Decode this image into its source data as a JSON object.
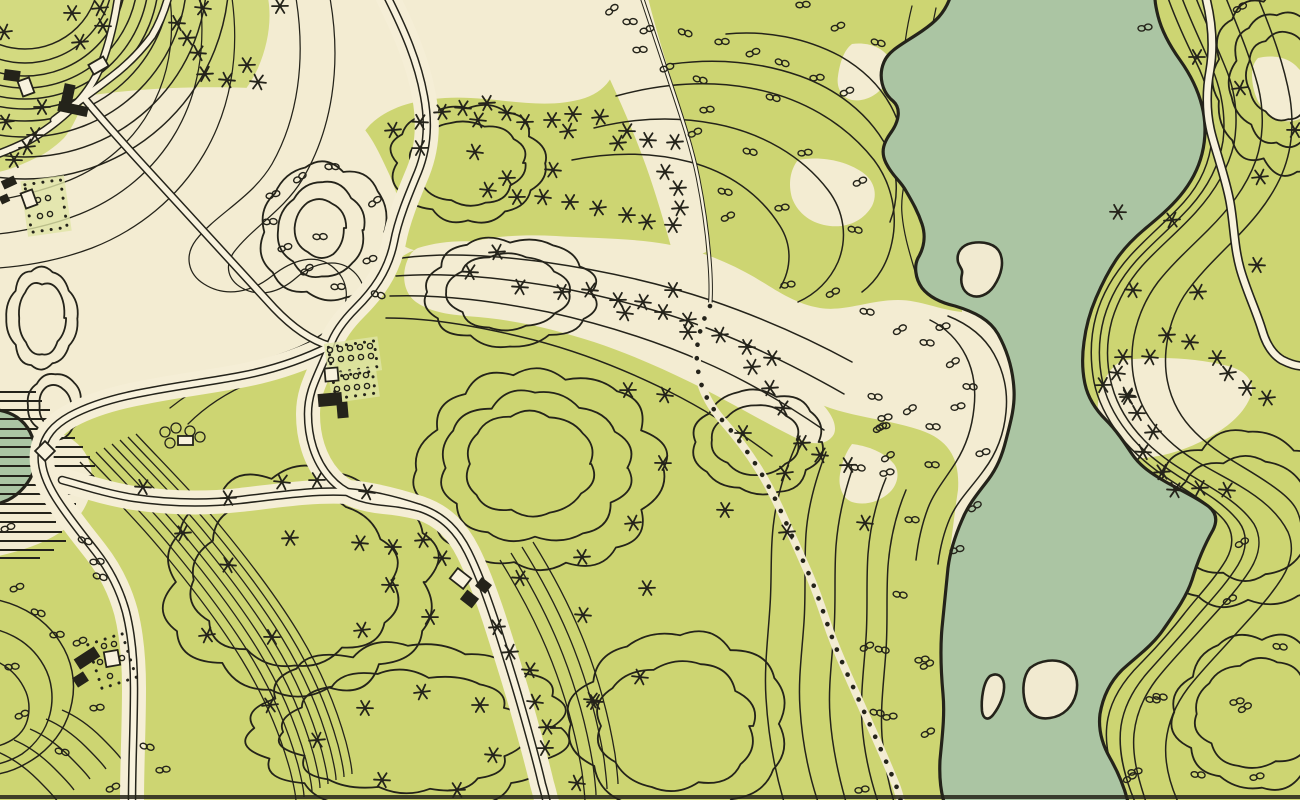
{
  "map": {
    "title": "Vintage hand-drawn topographic park survey map with lake channel, contour lines, wooded hills, winding roads, footpath and farmsteads",
    "style": "ink and watercolor plan, no text labels",
    "palette": {
      "paper": "#f3ecd2",
      "meadow": "#cdd572",
      "meadow_light": "#e0e5a6",
      "water": "#abc5a3",
      "ink": "#24231a",
      "road_fill": "#f8f2dd"
    },
    "legend": [
      {
        "symbol": "asterisk",
        "meaning": "coniferous tree"
      },
      {
        "symbol": "double-lobe",
        "meaning": "deciduous shrub / bush"
      },
      {
        "symbol": "solid-black-rectangle",
        "meaning": "building"
      },
      {
        "symbol": "open-rectangle",
        "meaning": "outbuilding / shed"
      },
      {
        "symbol": "dotted-square",
        "meaning": "garden plot / orchard"
      },
      {
        "symbol": "double-line",
        "meaning": "road"
      },
      {
        "symbol": "dotted-line",
        "meaning": "footpath"
      },
      {
        "symbol": "horizontal-hatching",
        "meaning": "marsh"
      },
      {
        "symbol": "thin-wavy-lines",
        "meaning": "elevation contours"
      },
      {
        "symbol": "scalloped-outline",
        "meaning": "wooded hilltop"
      }
    ],
    "features": {
      "water_bodies": 2,
      "islands": 3,
      "footpaths": 1,
      "road_junctions": 3,
      "building_clusters": 6
    }
  },
  "symbols": {
    "conifers": [
      [
        4,
        32
      ],
      [
        72,
        13
      ],
      [
        100,
        8
      ],
      [
        103,
        26
      ],
      [
        80,
        42
      ],
      [
        177,
        23
      ],
      [
        187,
        38
      ],
      [
        198,
        53
      ],
      [
        205,
        74
      ],
      [
        227,
        80
      ],
      [
        247,
        65
      ],
      [
        258,
        82
      ],
      [
        280,
        6
      ],
      [
        203,
        8
      ],
      [
        42,
        107
      ],
      [
        6,
        122
      ],
      [
        35,
        135
      ],
      [
        27,
        147
      ],
      [
        14,
        160
      ],
      [
        393,
        130
      ],
      [
        420,
        122
      ],
      [
        442,
        112
      ],
      [
        463,
        108
      ],
      [
        487,
        103
      ],
      [
        507,
        113
      ],
      [
        525,
        122
      ],
      [
        478,
        120
      ],
      [
        420,
        148
      ],
      [
        475,
        152
      ],
      [
        552,
        120
      ],
      [
        568,
        131
      ],
      [
        573,
        114
      ],
      [
        600,
        117
      ],
      [
        627,
        131
      ],
      [
        618,
        143
      ],
      [
        648,
        140
      ],
      [
        675,
        142
      ],
      [
        665,
        172
      ],
      [
        678,
        188
      ],
      [
        553,
        170
      ],
      [
        507,
        178
      ],
      [
        488,
        190
      ],
      [
        517,
        197
      ],
      [
        543,
        197
      ],
      [
        570,
        202
      ],
      [
        598,
        208
      ],
      [
        627,
        215
      ],
      [
        647,
        222
      ],
      [
        673,
        225
      ],
      [
        680,
        208
      ],
      [
        470,
        272
      ],
      [
        497,
        252
      ],
      [
        520,
        287
      ],
      [
        562,
        292
      ],
      [
        590,
        290
      ],
      [
        618,
        300
      ],
      [
        643,
        302
      ],
      [
        673,
        290
      ],
      [
        625,
        313
      ],
      [
        663,
        312
      ],
      [
        688,
        320
      ],
      [
        688,
        332
      ],
      [
        720,
        335
      ],
      [
        747,
        347
      ],
      [
        752,
        367
      ],
      [
        772,
        358
      ],
      [
        770,
        388
      ],
      [
        783,
        408
      ],
      [
        802,
        443
      ],
      [
        820,
        455
      ],
      [
        848,
        465
      ],
      [
        865,
        523
      ],
      [
        628,
        390
      ],
      [
        665,
        395
      ],
      [
        743,
        433
      ],
      [
        785,
        473
      ],
      [
        663,
        463
      ],
      [
        633,
        523
      ],
      [
        725,
        510
      ],
      [
        787,
        532
      ],
      [
        143,
        487
      ],
      [
        183,
        533
      ],
      [
        228,
        565
      ],
      [
        290,
        538
      ],
      [
        360,
        543
      ],
      [
        228,
        498
      ],
      [
        282,
        482
      ],
      [
        317,
        480
      ],
      [
        367,
        492
      ],
      [
        393,
        547
      ],
      [
        207,
        635
      ],
      [
        272,
        637
      ],
      [
        362,
        630
      ],
      [
        390,
        585
      ],
      [
        423,
        540
      ],
      [
        442,
        558
      ],
      [
        497,
        627
      ],
      [
        520,
        578
      ],
      [
        582,
        557
      ],
      [
        583,
        615
      ],
      [
        647,
        588
      ],
      [
        640,
        677
      ],
      [
        595,
        702
      ],
      [
        535,
        702
      ],
      [
        480,
        705
      ],
      [
        422,
        692
      ],
      [
        430,
        617
      ],
      [
        270,
        705
      ],
      [
        365,
        708
      ],
      [
        317,
        740
      ],
      [
        382,
        780
      ],
      [
        510,
        652
      ],
      [
        530,
        670
      ],
      [
        547,
        727
      ],
      [
        493,
        755
      ],
      [
        457,
        790
      ],
      [
        592,
        700
      ],
      [
        545,
        748
      ],
      [
        577,
        783
      ],
      [
        1197,
        57
      ],
      [
        1240,
        88
      ],
      [
        1295,
        130
      ],
      [
        1260,
        177
      ],
      [
        1118,
        212
      ],
      [
        1172,
        220
      ],
      [
        1257,
        265
      ],
      [
        1198,
        292
      ],
      [
        1133,
        290
      ],
      [
        1167,
        335
      ],
      [
        1190,
        342
      ],
      [
        1123,
        357
      ],
      [
        1150,
        357
      ],
      [
        1217,
        358
      ],
      [
        1117,
        373
      ],
      [
        1128,
        397
      ],
      [
        1228,
        373
      ],
      [
        1247,
        388
      ],
      [
        1267,
        398
      ],
      [
        1137,
        413
      ],
      [
        1153,
        432
      ],
      [
        1143,
        452
      ],
      [
        1162,
        472
      ],
      [
        1175,
        490
      ],
      [
        1200,
        488
      ],
      [
        1227,
        490
      ],
      [
        1103,
        385
      ],
      [
        1127,
        395
      ]
    ],
    "shrubs": [
      [
        612,
        10
      ],
      [
        630,
        22
      ],
      [
        647,
        30
      ],
      [
        685,
        33
      ],
      [
        722,
        42
      ],
      [
        753,
        53
      ],
      [
        782,
        63
      ],
      [
        640,
        50
      ],
      [
        667,
        68
      ],
      [
        700,
        80
      ],
      [
        803,
        5
      ],
      [
        838,
        27
      ],
      [
        878,
        43
      ],
      [
        817,
        78
      ],
      [
        847,
        92
      ],
      [
        773,
        98
      ],
      [
        707,
        110
      ],
      [
        695,
        133
      ],
      [
        750,
        152
      ],
      [
        805,
        153
      ],
      [
        860,
        182
      ],
      [
        725,
        192
      ],
      [
        782,
        208
      ],
      [
        728,
        217
      ],
      [
        855,
        230
      ],
      [
        788,
        285
      ],
      [
        833,
        293
      ],
      [
        867,
        312
      ],
      [
        1145,
        28
      ],
      [
        1240,
        8
      ],
      [
        875,
        397
      ],
      [
        885,
        418
      ],
      [
        880,
        428
      ],
      [
        858,
        468
      ],
      [
        887,
        473
      ],
      [
        900,
        330
      ],
      [
        927,
        343
      ],
      [
        943,
        327
      ],
      [
        953,
        363
      ],
      [
        970,
        387
      ],
      [
        958,
        407
      ],
      [
        910,
        410
      ],
      [
        933,
        427
      ],
      [
        883,
        427
      ],
      [
        888,
        457
      ],
      [
        932,
        465
      ],
      [
        983,
        453
      ],
      [
        975,
        507
      ],
      [
        912,
        520
      ],
      [
        957,
        550
      ],
      [
        300,
        178
      ],
      [
        332,
        167
      ],
      [
        273,
        195
      ],
      [
        375,
        202
      ],
      [
        320,
        237
      ],
      [
        285,
        248
      ],
      [
        307,
        270
      ],
      [
        338,
        287
      ],
      [
        370,
        260
      ],
      [
        378,
        295
      ],
      [
        270,
        222
      ],
      [
        8,
        528
      ],
      [
        85,
        541
      ],
      [
        97,
        562
      ],
      [
        17,
        588
      ],
      [
        38,
        613
      ],
      [
        57,
        635
      ],
      [
        80,
        642
      ],
      [
        100,
        577
      ],
      [
        12,
        667
      ],
      [
        22,
        715
      ],
      [
        62,
        752
      ],
      [
        97,
        708
      ],
      [
        113,
        788
      ],
      [
        147,
        747
      ],
      [
        163,
        770
      ],
      [
        867,
        647
      ],
      [
        882,
        650
      ],
      [
        922,
        660
      ],
      [
        927,
        665
      ],
      [
        877,
        713
      ],
      [
        890,
        717
      ],
      [
        928,
        733
      ],
      [
        900,
        595
      ],
      [
        862,
        790
      ],
      [
        1230,
        600
      ],
      [
        1160,
        697
      ],
      [
        1135,
        772
      ],
      [
        1242,
        543
      ],
      [
        1280,
        647
      ],
      [
        1237,
        702
      ],
      [
        1245,
        708
      ],
      [
        1198,
        775
      ],
      [
        1257,
        777
      ],
      [
        1130,
        778
      ],
      [
        1153,
        700
      ]
    ],
    "buildings_solid": [
      [
        4,
        70,
        16,
        11,
        8
      ],
      [
        62,
        84,
        11,
        26,
        12
      ],
      [
        58,
        104,
        30,
        10,
        12
      ],
      [
        2,
        178,
        14,
        9,
        -25
      ],
      [
        0,
        195,
        9,
        8,
        -25
      ],
      [
        318,
        393,
        24,
        13,
        -5
      ],
      [
        337,
        402,
        11,
        16,
        -5
      ],
      [
        477,
        580,
        13,
        11,
        38
      ],
      [
        462,
        593,
        15,
        12,
        38
      ],
      [
        75,
        652,
        24,
        12,
        -33
      ],
      [
        74,
        674,
        13,
        11,
        -33
      ]
    ],
    "buildings_open": [
      [
        20,
        79,
        12,
        16,
        -20
      ],
      [
        90,
        60,
        17,
        11,
        -30
      ],
      [
        23,
        191,
        12,
        16,
        -20
      ],
      [
        325,
        368,
        13,
        13,
        -5
      ],
      [
        178,
        436,
        15,
        9,
        0
      ],
      [
        105,
        651,
        14,
        15,
        -10
      ],
      [
        452,
        572,
        17,
        13,
        38
      ],
      [
        38,
        444,
        14,
        14,
        45
      ]
    ],
    "garden_plots": [
      {
        "x": 28,
        "y": 182,
        "w": 36,
        "h": 48,
        "rot": -8,
        "tint": true
      },
      {
        "x": 94,
        "y": 638,
        "w": 36,
        "h": 46,
        "rot": -18,
        "tint": false
      },
      {
        "x": 330,
        "y": 344,
        "w": 46,
        "h": 26,
        "rot": -8,
        "tint": true
      },
      {
        "x": 334,
        "y": 374,
        "w": 40,
        "h": 22,
        "rot": -8,
        "tint": true
      }
    ],
    "orchard_dots": [
      [
        330,
        350
      ],
      [
        340,
        349
      ],
      [
        350,
        348
      ],
      [
        360,
        347
      ],
      [
        370,
        346
      ],
      [
        331,
        360
      ],
      [
        341,
        359
      ],
      [
        351,
        358
      ],
      [
        361,
        357
      ],
      [
        371,
        356
      ],
      [
        336,
        378
      ],
      [
        346,
        377
      ],
      [
        356,
        376
      ],
      [
        366,
        375
      ],
      [
        337,
        389
      ],
      [
        347,
        388
      ],
      [
        357,
        387
      ],
      [
        367,
        386
      ],
      [
        38,
        200
      ],
      [
        48,
        198
      ],
      [
        40,
        216
      ],
      [
        50,
        214
      ],
      [
        104,
        646
      ],
      [
        114,
        644
      ],
      [
        100,
        662
      ],
      [
        122,
        658
      ],
      [
        110,
        676
      ]
    ],
    "crown_trees": [
      [
        165,
        432
      ],
      [
        176,
        428
      ],
      [
        190,
        431
      ],
      [
        200,
        437
      ],
      [
        170,
        443
      ]
    ]
  }
}
